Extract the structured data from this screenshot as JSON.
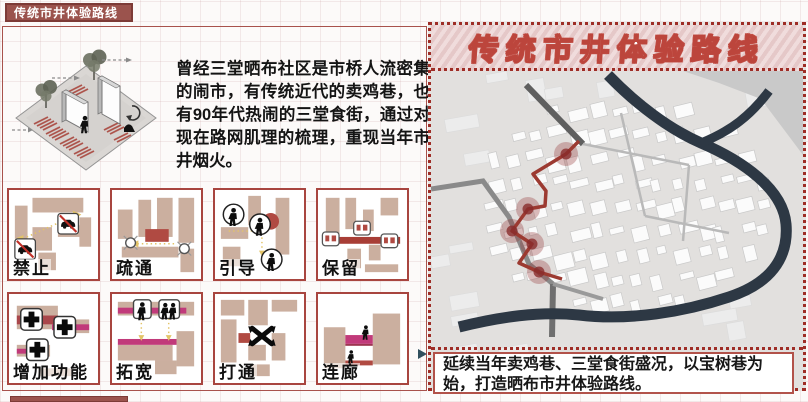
{
  "page": {
    "section_tab": "传统市井体验路线"
  },
  "left": {
    "paragraph": "曾经三堂晒布社区是市桥人流密集的闹市，有传统近代的卖鸡巷，也有90年代热闹的三堂食街，通过对现在路网肌理的梳理，重现当年市井烟火。",
    "strategies": [
      "禁止",
      "疏通",
      "引导",
      "保留",
      "增加功能",
      "拓宽",
      "打通",
      "连廊"
    ]
  },
  "right": {
    "title": "传统市井体验路线",
    "caption": "延续当年卖鸡巷、三堂食街盛况，以宝树巷为始，打造晒布市井体验路线。",
    "map": {
      "route_points": [
        [
          148,
          70
        ],
        [
          135,
          83
        ],
        [
          102,
          103
        ],
        [
          115,
          120
        ],
        [
          114,
          135
        ],
        [
          97,
          138
        ],
        [
          81,
          160
        ],
        [
          101,
          173
        ],
        [
          88,
          192
        ],
        [
          108,
          201
        ],
        [
          131,
          208
        ]
      ],
      "node_points": [
        [
          135,
          83
        ],
        [
          97,
          138
        ],
        [
          81,
          160
        ],
        [
          101,
          173
        ],
        [
          108,
          201
        ]
      ]
    }
  },
  "colors": {
    "accent": "#9b534d",
    "card_border": "#a8453f",
    "tan": "#cbaf9f",
    "red_block": "#b04a42",
    "magenta": "#c13a7a",
    "yellow": "#e3c468",
    "river": "#2d3844",
    "route": "#9c3a31"
  }
}
